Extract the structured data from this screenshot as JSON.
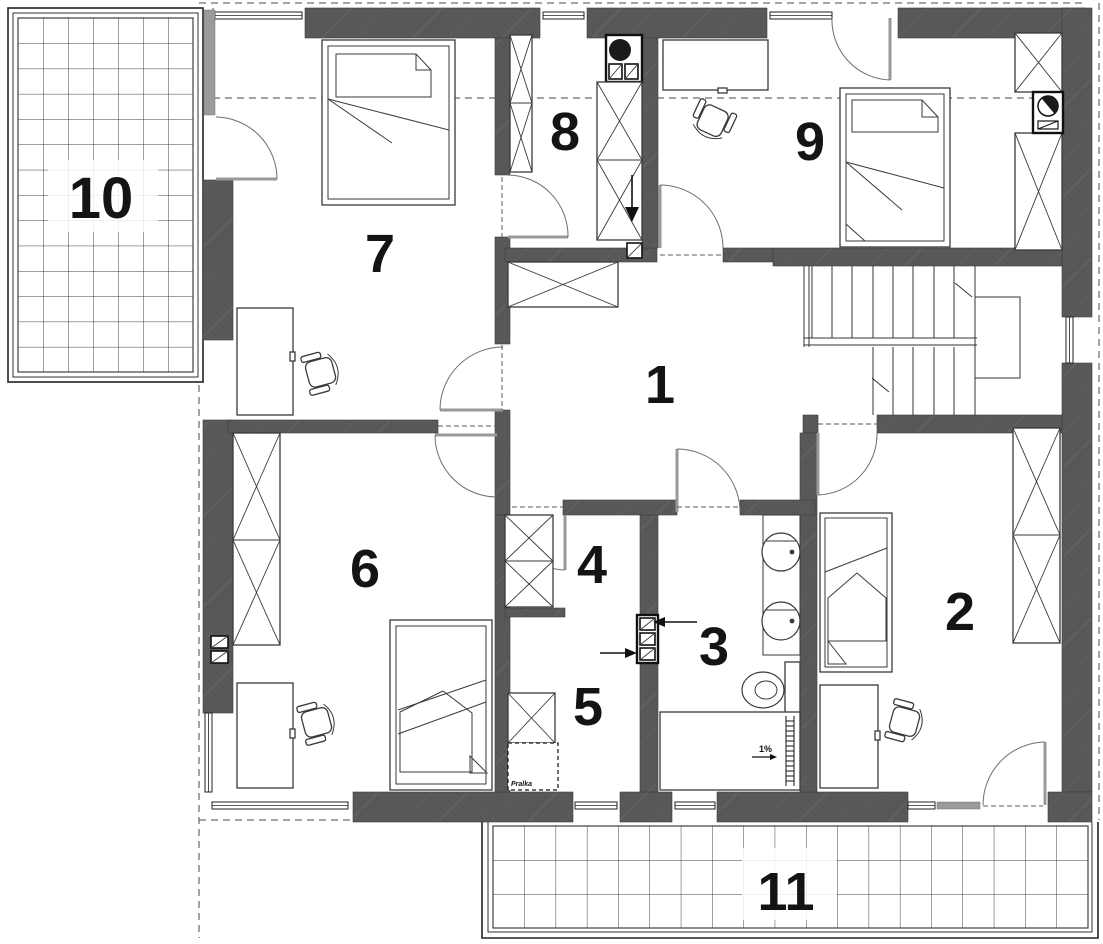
{
  "room_labels": {
    "r1": "1",
    "r2": "2",
    "r3": "3",
    "r4": "4",
    "r5": "5",
    "r6": "6",
    "r7": "7",
    "r8": "8",
    "r9": "9",
    "r10": "10",
    "r11": "11"
  },
  "annotations": {
    "washer_note": "Pralka",
    "slope_note": "1%"
  },
  "colors": {
    "wall": "#585858",
    "line": "#3a3a3a",
    "label": "#141414",
    "background": "#ffffff"
  }
}
